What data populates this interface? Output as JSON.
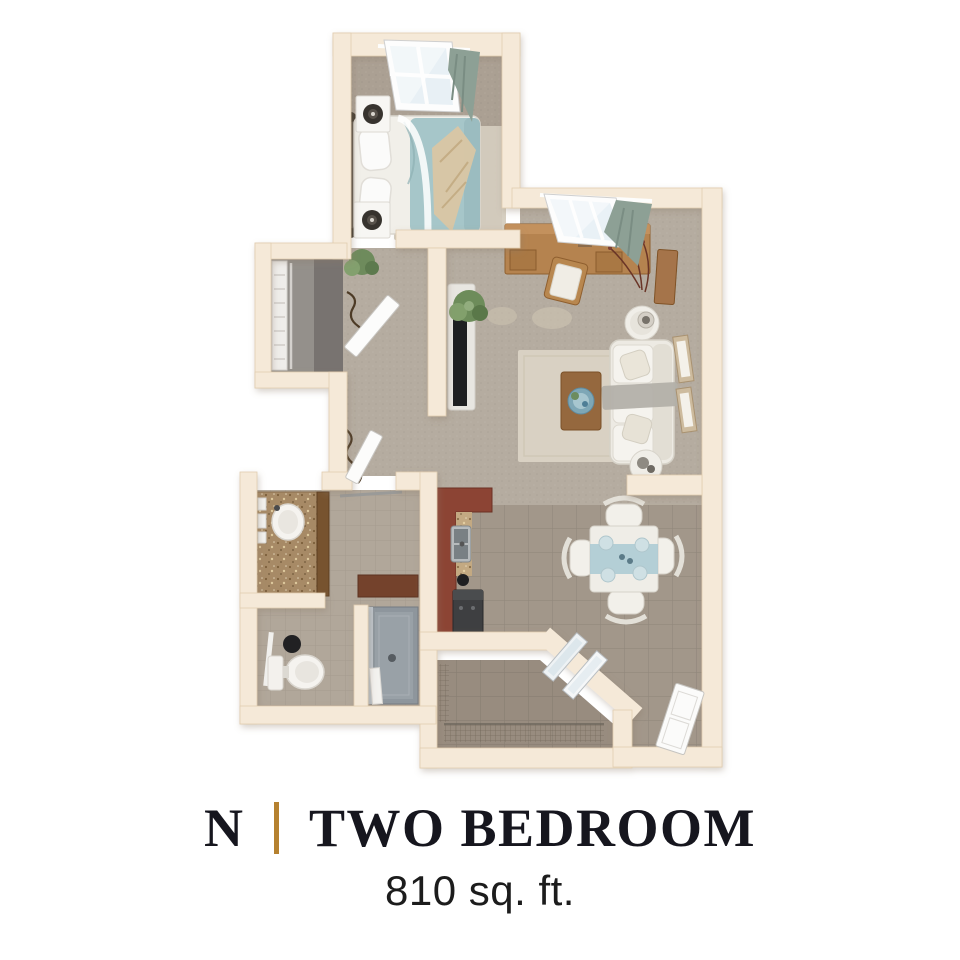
{
  "caption": {
    "plan_letter": "N",
    "plan_name": "TWO BEDROOM",
    "area": "810 sq. ft."
  },
  "colors": {
    "background": "#ffffff",
    "title_text": "#16161e",
    "accent_gold": "#b5812f",
    "wall_beige": "#f5e9d8",
    "carpet": "#b5aca0",
    "bedroom_carpet": "#aba093",
    "tile": "#a2978a",
    "patio_tile": "#988c7f",
    "bathroom_tile": "#b1a79a",
    "closet_floor": "#94908b",
    "kitchen_cabinet": "#8c4434",
    "granite": "#a78a66",
    "bedding_teal": "#a6c6c9",
    "throw_cream": "#d9c6a4",
    "curtain_sage": "#8da095",
    "sofa_cream": "#edeae3",
    "wood_desk": "#b5834f",
    "rug_cream": "#d8d0c2"
  }
}
